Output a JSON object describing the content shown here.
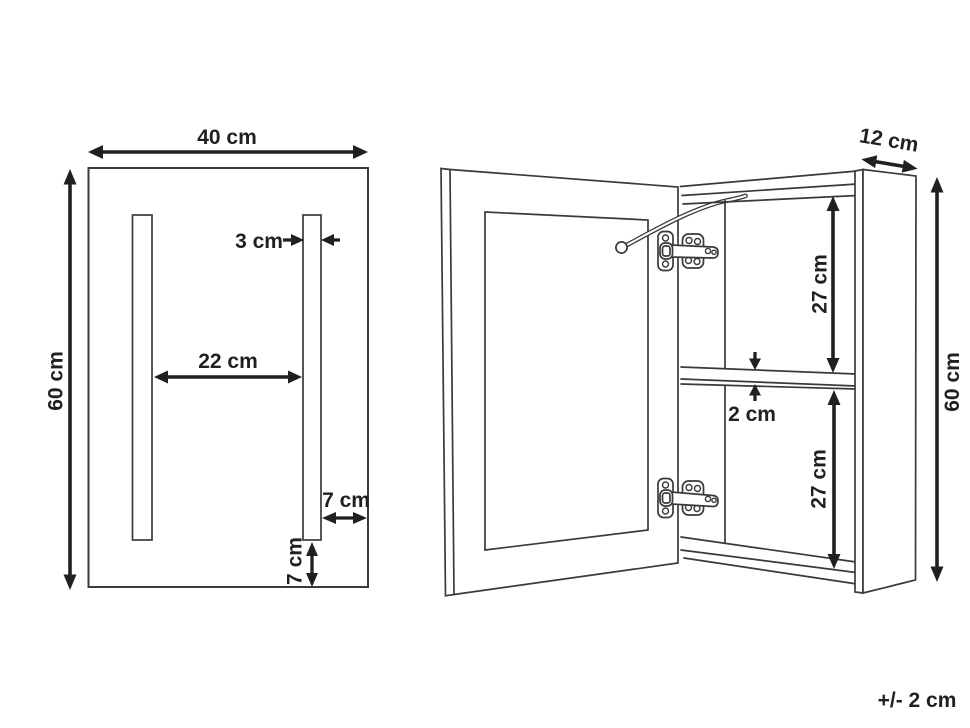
{
  "front_view": {
    "width": "40 cm",
    "height": "60 cm",
    "led_strip_width": "3 cm",
    "led_strip_spacing": "22 cm",
    "led_strip_side_offset": "7 cm",
    "led_strip_bottom_offset": "7 cm"
  },
  "side_view": {
    "depth": "12 cm",
    "height": "60 cm",
    "upper_compartment_height": "27 cm",
    "shelf_thickness": "2 cm",
    "lower_compartment_height": "27 cm"
  },
  "footnote": "+/- 2 cm",
  "colors": {
    "line": "#3a3a39",
    "label": "#231f20",
    "background": "#ffffff"
  }
}
